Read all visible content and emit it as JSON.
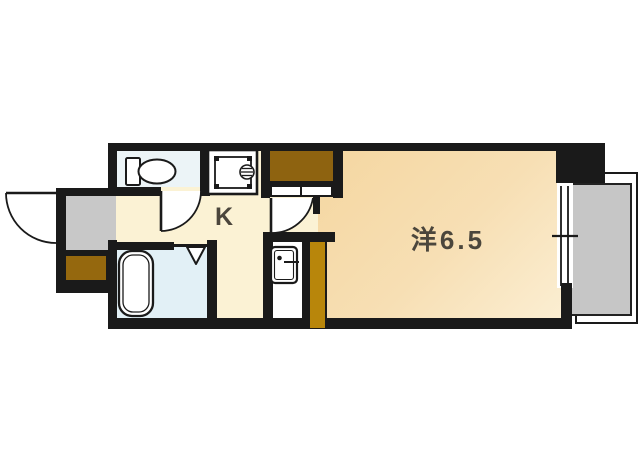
{
  "floor_plan": {
    "type": "japanese-apartment-1k-floorplan",
    "kitchen_label": "K",
    "room_label": "洋6.5"
  },
  "palette": {
    "wall": "#1a1a1a",
    "kitchen_floor": "#fbf2d4",
    "main_room_floor": "#f6dcae",
    "toilet_floor": "#ecf4f7",
    "bathroom_floor": "#e2f0f6",
    "genkan_gray": "#c8c8c8",
    "balcony_gray": "#c6c6c6",
    "closet_brown": "#8e6310",
    "shoe_cabinet_brown": "#95680e",
    "counter_brown": "#b8860b",
    "label_text": "#4b463c",
    "background": "#ffffff"
  },
  "fixture_icons": [
    "entrance-door-swing-icon",
    "shoe-cabinet-icon",
    "genkan-entry-icon",
    "toilet-icon",
    "toilet-door-swing-icon",
    "kitchen-sink-stove-icon",
    "closet-icon",
    "room-door-swing-icon",
    "refrigerator-icon",
    "counter-icon",
    "bathtub-icon",
    "folding-door-icon",
    "window-icon",
    "balcony-icon"
  ]
}
